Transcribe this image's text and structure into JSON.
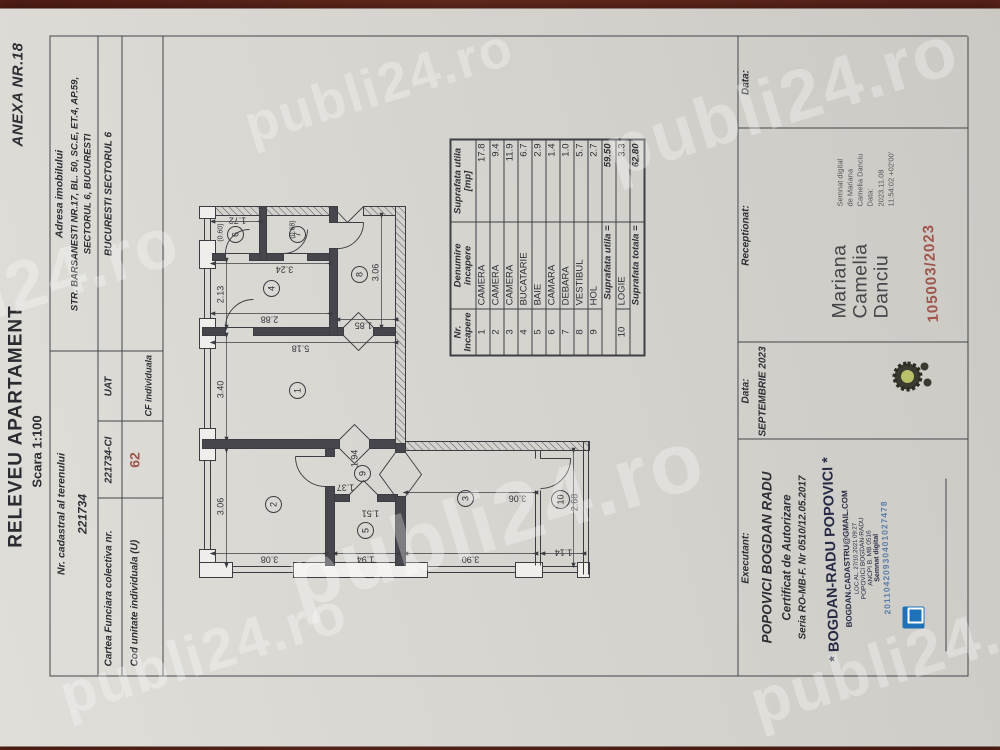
{
  "page": {
    "anexa": "ANEXA NR.18",
    "title": "RELEVEU APARTAMENT",
    "scale": "Scara 1:100"
  },
  "header": {
    "cadastral_label": "Nr. cadastral al terenului",
    "cadastral_value": "221734",
    "address_label": "Adresa imobilului",
    "address_line1": "STR. BARSANESTI NR.17, BL. 50, SC.E, ET.4, AP.59,",
    "address_line2": "SECTORUL 6, BUCURESTI",
    "cf_label": "Cartea Funciara colectiva nr.",
    "cf_value": "221734-CI",
    "uat_label": "UAT",
    "uat_value": "BUCURESTI SECTORUL 6",
    "unit_label": "Cod unitate individuala (U)",
    "unit_value": "62",
    "cf_individual_label": "CF individuala"
  },
  "room_table": {
    "col1_l1": "Nr.",
    "col1_l2": "Incapere",
    "col2_l1": "Denumire",
    "col2_l2": "incapere",
    "col3_l1": "Suprafata utila",
    "col3_l2": "[mp]",
    "rows": [
      {
        "nr": "1",
        "name": "CAMERA",
        "mp": "17.8"
      },
      {
        "nr": "2",
        "name": "CAMERA",
        "mp": "9.4"
      },
      {
        "nr": "3",
        "name": "CAMERA",
        "mp": "11.9"
      },
      {
        "nr": "4",
        "name": "BUCATARIE",
        "mp": "6.7"
      },
      {
        "nr": "5",
        "name": "BAIE",
        "mp": "2.9"
      },
      {
        "nr": "6",
        "name": "CAMARA",
        "mp": "1.4"
      },
      {
        "nr": "7",
        "name": "DEBARA",
        "mp": "1.0"
      },
      {
        "nr": "8",
        "name": "VESTIBUL",
        "mp": "5.7"
      },
      {
        "nr": "9",
        "name": "HOL",
        "mp": "2.7"
      }
    ],
    "subtotal_label": "Suprafata utila =",
    "subtotal_value": "59.50",
    "logie_row": {
      "nr": "10",
      "name": "LOGIE",
      "mp": "3.3"
    },
    "total_label": "Suprafata totala =",
    "total_value": "62.80"
  },
  "plan": {
    "rooms": [
      {
        "num": "1"
      },
      {
        "num": "2"
      },
      {
        "num": "3"
      },
      {
        "num": "4"
      },
      {
        "num": "5"
      },
      {
        "num": "6"
      },
      {
        "num": "7"
      },
      {
        "num": "8"
      },
      {
        "num": "9"
      },
      {
        "num": "10"
      }
    ],
    "dims": [
      {
        "v": "3.06"
      },
      {
        "v": "3.40"
      },
      {
        "v": "2.13"
      },
      {
        "v": "(0.60)"
      },
      {
        "v": "1.72"
      },
      {
        "v": "(0.68)"
      },
      {
        "v": "3.24"
      },
      {
        "v": "2.88"
      },
      {
        "v": "5.18"
      },
      {
        "v": "1.85"
      },
      {
        "v": "3.06"
      },
      {
        "v": "3.08"
      },
      {
        "v": "1.94"
      },
      {
        "v": "3.90"
      },
      {
        "v": "1.14"
      },
      {
        "v": "1.37"
      },
      {
        "v": "1.94"
      },
      {
        "v": "1.51"
      },
      {
        "v": "3.06"
      },
      {
        "v": "2.68"
      }
    ]
  },
  "footer": {
    "executant_label": "Executant:",
    "executant_name": "POPOVICI BOGDAN RADU",
    "cert_line1": "Certificat de Autorizare",
    "cert_line2": "Seria RO-MB-F. Nr 0510/12.05.2017",
    "stamp_name": "* BOGDAN-RADU POPOVICI *",
    "stamp_email": "BOGDAN.CADASTRU@GMAIL.COM",
    "stamp_tiny1": "LOC.AL. 27/10.2021 09:27",
    "stamp_tiny2": "POPOVICI BOGDAN-RADU",
    "stamp_tiny3": "ANCPI B. MB 0516",
    "stamp_tiny4": "Semnat digital",
    "stamp_serial": "20110420930401027478",
    "data_label": "Data:",
    "data_value": "SEPTEMBRIE 2023",
    "receptionat_label": "Receptionat:",
    "sig_name_l1": "Mariana",
    "sig_name_l2": "Camelia",
    "sig_name_l3": "Danciu",
    "sig_detail": [
      "Semnat digital",
      "de Mariana",
      "Camelia Danciu",
      "Data:",
      "2023.11.08",
      "11:54:02 +02'00'"
    ],
    "reg_number": "105003/2023",
    "data2_label": "Data:"
  },
  "watermark": {
    "text": "publi24.ro"
  },
  "colors": {
    "accent_red": "#a0564c",
    "stamp_blue": "#5b7ca8",
    "stamp_navy": "#262a44",
    "background": "#5a2118"
  }
}
